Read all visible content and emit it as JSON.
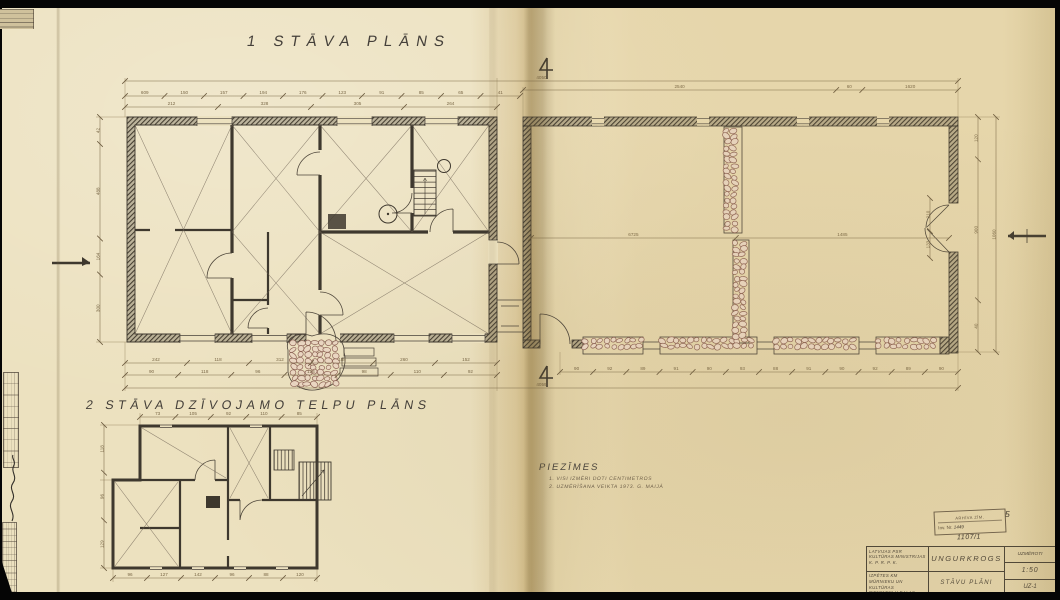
{
  "page": {
    "title1": "1 STĀVA PLĀNS",
    "title2": "2 STĀVA DZĪVOJAMO TELPU PLĀNS",
    "notes_header": "PIEZĪMES",
    "note1": "1. VISI IZMĒRI DOTI CENTIMETROS",
    "note2": "2. UZMĒRĪŠANA VEIKTA 1973. G. MAIJĀ"
  },
  "title_block": {
    "org1": "LATVIJAS PSR",
    "org2": "KULTŪRAS MINISTRIJAS",
    "org3": "K. P. R. P. K.",
    "obj1": "IZPĒTES KM",
    "obj2": "MŪRNIEKU UN KULTŪRAS",
    "obj3": "PIEMINEKĻU DAĻAS",
    "obj4": "AR PĒT. BIEDRI",
    "project": "UNGURKROGS",
    "drawing": "STĀVU PLĀNI",
    "status": "UZMĒROTI",
    "scale": "1:50",
    "sheet": "UZ-1"
  },
  "stamp": {
    "line1": "ARHĪVA ZĪM.",
    "inv_label": "Inv. Nr.",
    "inv_no": "1449",
    "number": "1107/1",
    "mark": "5"
  },
  "dims": {
    "overall_top": [
      "4050"
    ],
    "top_left": [
      "609",
      "150",
      "157",
      "194",
      "176",
      "123",
      "91",
      "85",
      "65",
      "41"
    ],
    "top_left2": [
      "212",
      "328",
      "305",
      "264"
    ],
    "top_right": [
      "2540",
      "60",
      "1620"
    ],
    "bottom_left1": [
      "242",
      "118",
      "312",
      "188",
      "260",
      "152"
    ],
    "bottom_left2": [
      "90",
      "118",
      "96",
      "124",
      "98",
      "110",
      "92"
    ],
    "bottom_barn": [
      "90",
      "92",
      "89",
      "91",
      "90",
      "93",
      "88",
      "91",
      "90",
      "92",
      "89",
      "90"
    ],
    "overall_bottom": [
      "4059"
    ],
    "left_side": [
      "42",
      "488",
      "164",
      "300"
    ],
    "right_side": [
      "120",
      "900",
      "40"
    ],
    "right_overall": [
      "1060"
    ],
    "barn_inner": [
      "6725",
      "1485"
    ],
    "door_side": [
      "210",
      "133"
    ],
    "plan2_top": [
      "73",
      "105",
      "92",
      "110",
      "85"
    ],
    "plan2_bottom": [
      "96",
      "127",
      "142",
      "96",
      "88",
      "120"
    ],
    "plan2_left": [
      "118",
      "96",
      "129"
    ]
  }
}
